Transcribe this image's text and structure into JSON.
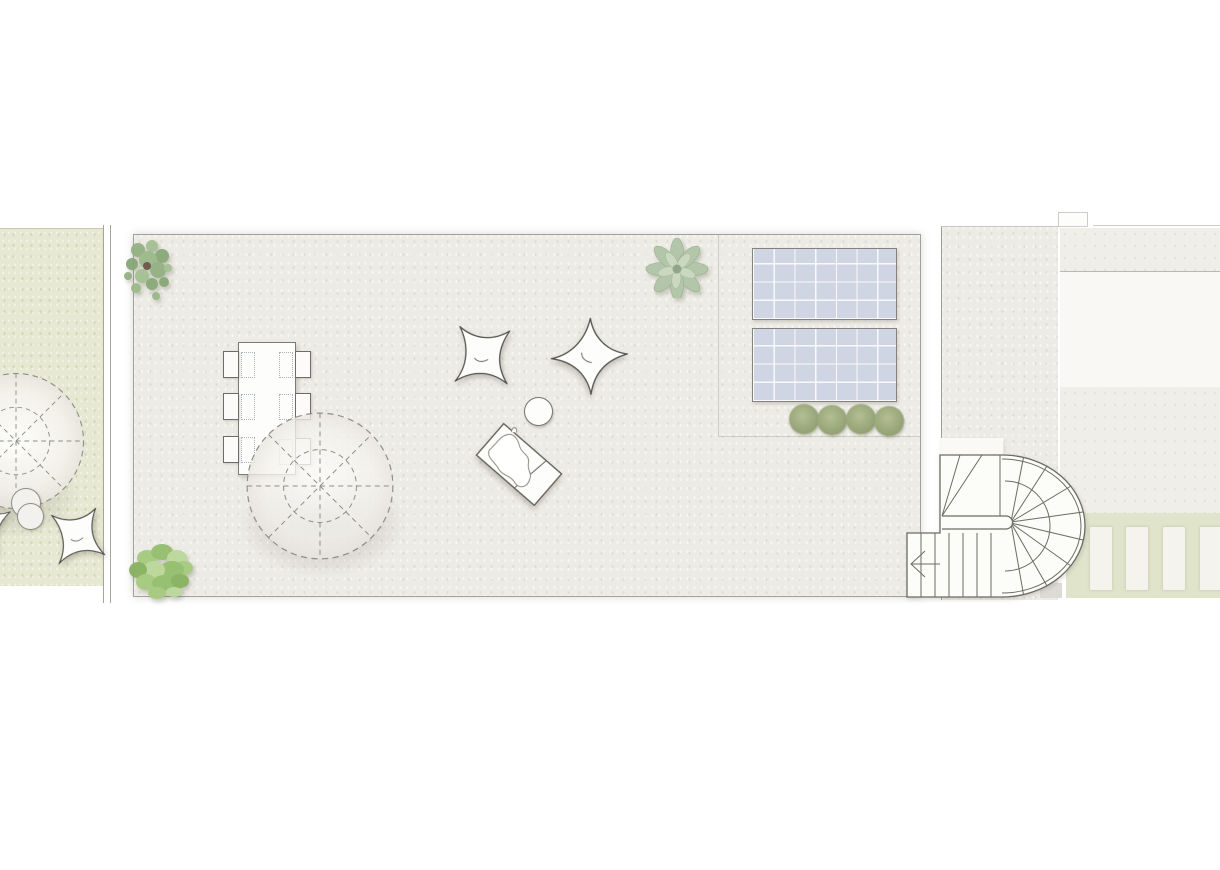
{
  "plan": {
    "kind": "roof-terrace-floor-plan",
    "colors": {
      "page_bg": "#ffffff",
      "terrace": "#edebe5",
      "terrace_border": "#a3a29a",
      "garden": "#e6e8d2",
      "right_band": "#f0eee9",
      "white_panel": "#f9f8f5",
      "divider": "#b9b8b0",
      "pergola": "#e0e4cb",
      "slat": "#f4f3ee",
      "solar_fill": "#cfd5e2",
      "solar_border": "#83827c",
      "line": "#6c6c65",
      "furniture_stroke": "#56544e",
      "shadow": "rgba(100,96,84,0.38)"
    },
    "areas": [
      {
        "name": "neighbor-garden"
      },
      {
        "name": "boundary-wall"
      },
      {
        "name": "main-roof-terrace"
      },
      {
        "name": "technical-zone"
      },
      {
        "name": "stair-walkway"
      },
      {
        "name": "adjacent-roof"
      },
      {
        "name": "pergola-strip"
      }
    ],
    "furniture": [
      {
        "name": "dining-table",
        "seats": 6
      },
      {
        "name": "parasol",
        "count": 2
      },
      {
        "name": "bean-bag",
        "count": 4
      },
      {
        "name": "sun-lounger",
        "count": 1
      },
      {
        "name": "side-table",
        "count": 1
      },
      {
        "name": "pouf",
        "count": 2
      },
      {
        "name": "solar-panel",
        "count": 2
      },
      {
        "name": "u-shaped-staircase",
        "count": 1
      },
      {
        "name": "plants",
        "count": 7
      }
    ],
    "chairs": [
      {
        "x": 223,
        "y": 351,
        "w": 16,
        "h": 27
      },
      {
        "x": 223,
        "y": 393,
        "w": 16,
        "h": 27
      },
      {
        "x": 223,
        "y": 436,
        "w": 16,
        "h": 27
      },
      {
        "x": 295,
        "y": 351,
        "w": 16,
        "h": 27
      },
      {
        "x": 295,
        "y": 393,
        "w": 16,
        "h": 27
      },
      {
        "x": 295,
        "y": 438,
        "w": 16,
        "h": 27
      }
    ],
    "seat_outlines": [
      {
        "x": 241,
        "y": 352,
        "w": 14,
        "h": 26
      },
      {
        "x": 241,
        "y": 394,
        "w": 14,
        "h": 26
      },
      {
        "x": 241,
        "y": 437,
        "w": 14,
        "h": 26
      },
      {
        "x": 279,
        "y": 352,
        "w": 14,
        "h": 26
      },
      {
        "x": 279,
        "y": 394,
        "w": 14,
        "h": 26
      },
      {
        "x": 279,
        "y": 439,
        "w": 14,
        "h": 26
      }
    ],
    "solar_panels": [
      {
        "x": 752,
        "y": 248,
        "w": 145,
        "h": 72
      },
      {
        "x": 752,
        "y": 328,
        "w": 145,
        "h": 74
      }
    ],
    "shrubs": [
      {
        "x": 789,
        "y": 404
      },
      {
        "x": 817,
        "y": 405
      },
      {
        "x": 846,
        "y": 404
      },
      {
        "x": 874,
        "y": 406
      }
    ],
    "slats": [
      {
        "x": 24
      },
      {
        "x": 60
      },
      {
        "x": 97
      },
      {
        "x": 134
      }
    ]
  }
}
